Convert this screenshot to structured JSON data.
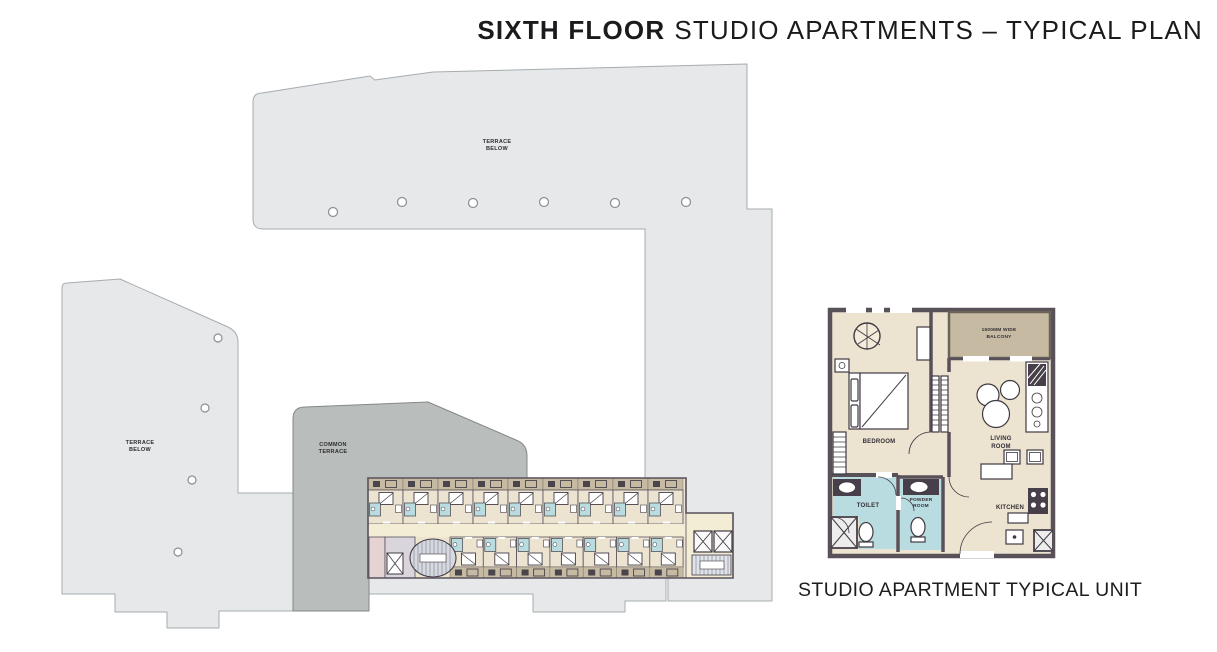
{
  "title": {
    "emphasis": "SIXTH FLOOR",
    "rest": "STUDIO APARTMENTS – TYPICAL PLAN"
  },
  "caption": "STUDIO APARTMENT TYPICAL UNIT",
  "floor_plan": {
    "terrace_top_label": {
      "line1": "TERRACE",
      "line2": "BELOW"
    },
    "terrace_left_label": {
      "line1": "TERRACE",
      "line2": "BELOW"
    },
    "common_terrace_label": {
      "line1": "COMMON",
      "line2": "TERRACE"
    },
    "strip": {
      "top_units": 9,
      "bottom_units": 7
    }
  },
  "unit_plan": {
    "balcony_label": {
      "line1": "1500MM WIDE",
      "line2": "BALCONY"
    },
    "bedroom_label": "BEDROOM",
    "living_room_label": {
      "line1": "LIVING",
      "line2": "ROOM"
    },
    "toilet_label": "TOILET",
    "powder_room_label": {
      "line1": "POWDER",
      "line2": "ROOM"
    },
    "kitchen_label": "KITCHEN"
  },
  "colors": {
    "terrace_fill": "#e6e8ea",
    "terrace_stroke": "#a7acaf",
    "common_terrace_fill": "#b9bdbb",
    "common_terrace_stroke": "#83888b",
    "unit_floor": "#ece3d1",
    "corridor": "#f3edd6",
    "balcony_tan": "#c6baa2",
    "bathroom_blue": "#b9dce1",
    "wall": "#58515a",
    "title_color": "#1b1b1d"
  }
}
